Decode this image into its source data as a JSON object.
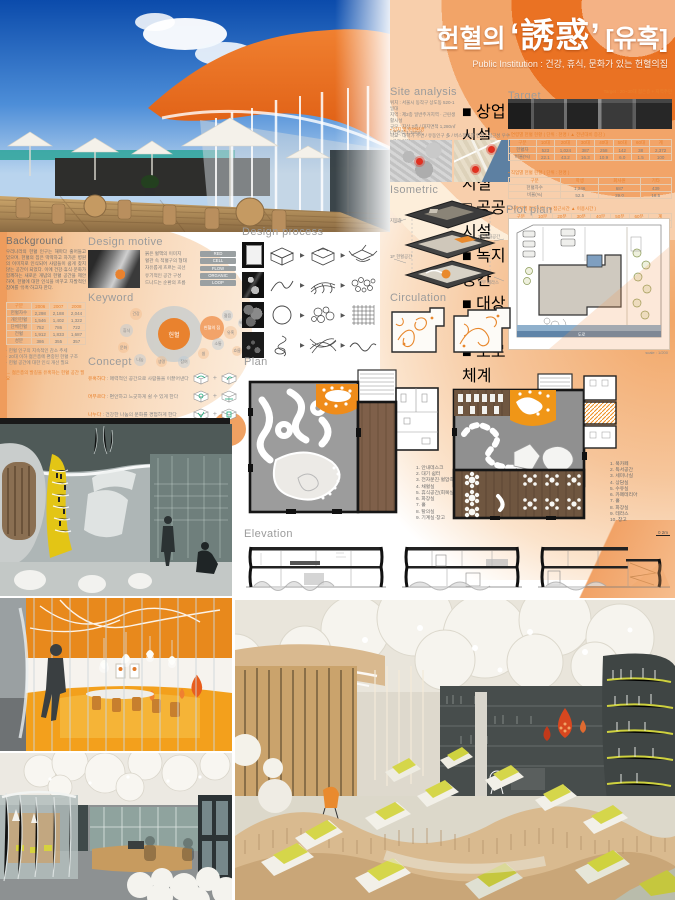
{
  "poster": {
    "accent": "#e97224"
  },
  "title": {
    "prefix": "헌혈의",
    "main": "‘誘惑’",
    "bracket": "[유혹]",
    "subtitle": "Public Institution : 건강, 휴식, 문화가 있는 헌혈의집"
  },
  "site_analysis": {
    "title": "Site analysis",
    "lines": [
      "위치 : 서울시 동작구 상도동 520-1 일대",
      "지역 : 제2종 일반주거지역 · 근린생활시설",
      "규모 : 지상 2층 / 대지면적 1,280㎡ / 연면적 1,150㎡"
    ],
    "legend": [
      "■ 상업시설",
      "■ 주거시설",
      "□ 공공시설",
      "■ 녹지공간",
      "■ 대상대지",
      "■ 도로체계"
    ],
    "note_title": "▪ 입지 및 주변환경",
    "note": "학교 · 대학가 주변 / 유동인구 多 / 버스정류장 인접 / 접근성 우수 / 공원 인접"
  },
  "target": {
    "title": "Target",
    "note": "Target : 20~30대 젊은층 + 지역주민",
    "bullet1": "▪ 연령별 헌혈 현황 ( 단위 : 천명 / ▲ 전년대비 증감 )",
    "table1": {
      "headers": [
        "구분",
        "10대",
        "20대",
        "30대",
        "40대",
        "50대",
        "60대",
        "계"
      ],
      "rows": [
        [
          "헌혈자",
          "523",
          "1,024",
          "387",
          "258",
          "142",
          "38",
          "2,372"
        ],
        [
          "비율(%)",
          "22.1",
          "43.2",
          "16.3",
          "10.9",
          "6.0",
          "1.5",
          "100"
        ]
      ]
    },
    "bullet2": "▪ 직업별 헌혈 현황 ( 단위 : 천명 )",
    "table2": {
      "headers": [
        "구분",
        "학생",
        "회사원",
        "기타"
      ],
      "rows": [
        [
          "헌혈자수",
          "1,246",
          "687",
          "439"
        ],
        [
          "비율(%)",
          "52.5",
          "29.0",
          "18.5"
        ]
      ]
    },
    "bullet3": "▪ 거주지별 접근시간 ( ■ 접근시간 ▲ 이용시간 )",
    "table3": {
      "headers": [
        "구분",
        "10분",
        "20분",
        "30분",
        "40분",
        "50분",
        "60분",
        "계"
      ],
      "rows": [
        [
          "이용자",
          "412",
          "386",
          "274",
          "158",
          "96",
          "46",
          "1,372"
        ]
      ]
    }
  },
  "isometric": {
    "title": "Isometric",
    "labels": [
      "지붕층",
      "2F 문화공간",
      "1F 헌혈공간",
      "외부 테라스"
    ]
  },
  "plot_plan": {
    "title": "Plot plan",
    "road_label": "도로",
    "scale": "scale : 1/200"
  },
  "circulation": {
    "title": "Circulation",
    "labels": [
      "1F",
      "2F"
    ]
  },
  "design_process": {
    "title": "Design process",
    "arrow": "▶",
    "rows": [
      {
        "caption": "mass → 분할 → open"
      },
      {
        "caption": "혈관 → 흐름 → 곡선"
      },
      {
        "caption": "세포 → 군집 → 패턴"
      },
      {
        "caption": "핏줄 → 엮임 → 물결"
      }
    ]
  },
  "plan": {
    "title": "Plan",
    "legend1": [
      "1. 안내데스크",
      "2. 대기 쉼터",
      "3. 전자문진·혈압측정",
      "4. 채혈실",
      "5. 휴식공간(회복실)",
      "6. 화장실",
      "7. 홀",
      "8. 탈의실",
      "9. 기계실·창고"
    ],
    "legend2": [
      "1. 북카페",
      "2. 독서공간",
      "3. 세미나실",
      "4. 상담실",
      "5. 수유실",
      "6. 카페테리아",
      "7. 홀",
      "8. 화장실",
      "9. 테라스",
      "10. 창고"
    ]
  },
  "elevation": {
    "title": "Elevation",
    "scale": "0    2m"
  },
  "background": {
    "title": "Background",
    "paragraph": "우리나라의 헌혈 인구는 해마다 줄어들고 있으며, 헌혈의 집은 딱딱하고 차가운 병원의 이미지로 인식되어 사람들이 쉽게 찾지 않는 공간이 되었다. 이에 건강·휴식·문화가 함께하는 새로운 개념의 헌혈 공간을 제안하여, 헌혈에 대한 인식을 바꾸고 자발적인 참여를 ‘유혹’하고자 한다.",
    "table": {
      "headers": [
        "구분",
        "2006",
        "2007",
        "2008"
      ],
      "rows": [
        [
          "헌혈자수",
          "2,298",
          "2,188",
          "2,044"
        ],
        [
          "개인헌혈",
          "1,546",
          "1,402",
          "1,322"
        ],
        [
          "단체헌혈",
          "752",
          "786",
          "722"
        ],
        [
          "전혈",
          "1,912",
          "1,833",
          "1,687"
        ],
        [
          "성분",
          "386",
          "355",
          "357"
        ]
      ]
    },
    "notes": [
      "· 헌혈 인구의 지속적인 감소 추세",
      "· 20대 이하 젊은층에 편중된 헌혈 구조",
      "· 헌혈 공간에 대한 인식 개선 필요"
    ],
    "point": "→ 젊은층의 발길을 유혹하는 헌혈 공간 필요"
  },
  "design_motive": {
    "title": "Design motive",
    "items": [
      {
        "label": "붉은 혈액의 이미지",
        "tag": "RED"
      },
      {
        "label": "혈관 속 적혈구의 형태",
        "tag": "CELL"
      },
      {
        "label": "자유롭게 흐르는 곡선",
        "tag": "FLOW"
      },
      {
        "label": "유기적인 공간 구성",
        "tag": "ORGANIC"
      },
      {
        "label": "드나드는 순환의 흐름",
        "tag": "LOOP"
      }
    ]
  },
  "keyword": {
    "title": "Keyword",
    "center": "헌혈",
    "secondary": "헌혈의 집",
    "bubbles": [
      "건강",
      "휴식",
      "문화",
      "나눔",
      "생명",
      "참여",
      "쉼",
      "소통",
      "유혹",
      "젊음",
      "흐름",
      "배려"
    ]
  },
  "concept": {
    "title": "Concept",
    "plus": "+",
    "rows": [
      {
        "accent": "유혹하다",
        "text": " : 매력적인 공간으로 사람들을 이끌어낸다"
      },
      {
        "accent": "머무르다",
        "text": " : 편안하고 느긋하게 쉴 수 있게 한다"
      },
      {
        "accent": "나누다",
        "text": " : 건강한 나눔의 문화를 경험하게 한다"
      }
    ]
  }
}
